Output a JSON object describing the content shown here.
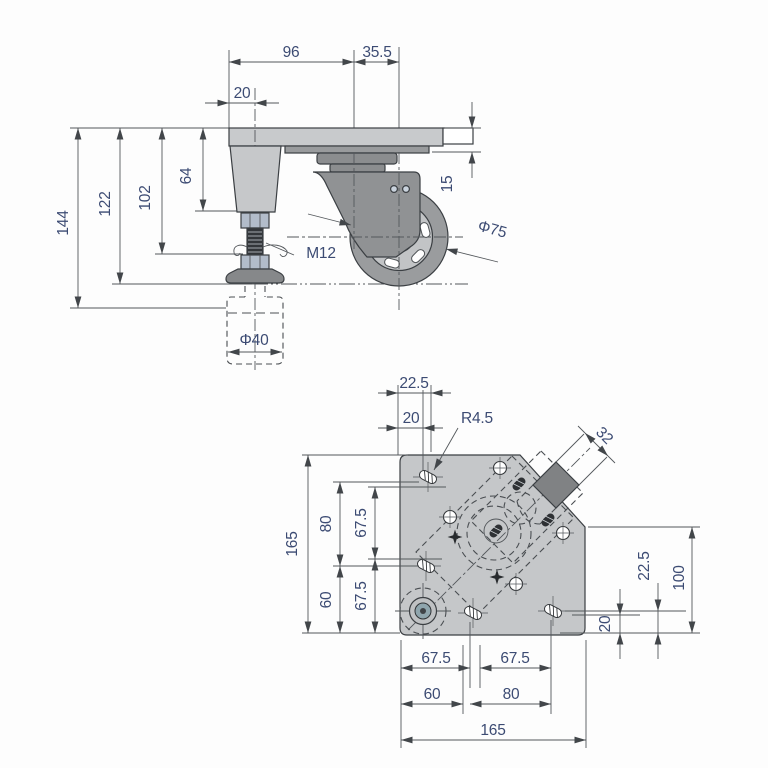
{
  "drawing_type": "technical-drawing-caster-with-leveling-foot",
  "views": {
    "side_view": "caster and adjuster foot side elevation",
    "bottom_view": "mounting plate bottom view"
  },
  "dims": {
    "side": {
      "plate_width": "96",
      "caster_offset": "35.5",
      "edge_to_leg": "20",
      "block_height": "64",
      "to_clip": "102",
      "to_ground": "122",
      "overall_height": "144",
      "plate_thickness": "15",
      "thread_label": "M12",
      "wheel_diameter": "Φ75",
      "foot_diameter": "Φ40"
    },
    "bottom": {
      "top_22_5": "22.5",
      "top_20": "20",
      "corner_radius": "R4.5",
      "wheel_width": "32",
      "left_165": "165",
      "left_80": "80",
      "left_60": "60",
      "left_67_upper": "67.5",
      "left_67_lower": "67.5",
      "right_22_5": "22.5",
      "right_100": "100",
      "right_20": "20",
      "bottom_67_left": "67.5",
      "bottom_67_right": "67.5",
      "bottom_60": "60",
      "bottom_80": "80",
      "bottom_165": "165"
    }
  },
  "colors": {
    "dim_text": "#3c4b73",
    "outline": "#3b3f43",
    "thin_line": "#54585c",
    "plate_fill": "#c8cacc",
    "bracket_fill": "#909294",
    "wheel_tire": "#9a9c9e",
    "hub_fill": "#c2c4c6",
    "nut_fill": "#b2bcca",
    "rod_fill": "#33363a",
    "bearing_blue": "#7f95ad"
  }
}
